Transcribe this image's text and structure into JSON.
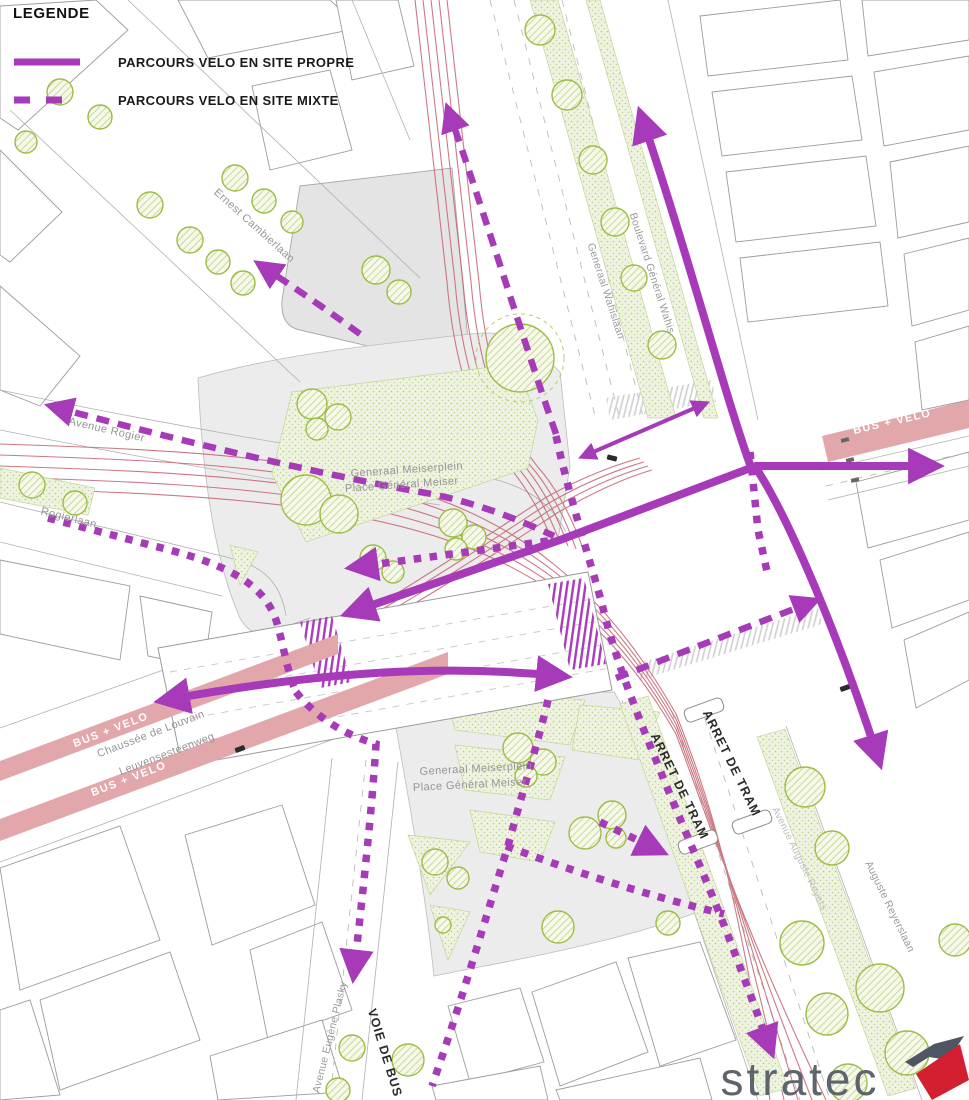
{
  "legend": {
    "title": "LEGENDE",
    "items": [
      {
        "id": "site-propre",
        "label": "PARCOURS VELO EN SITE PROPRE",
        "line_style": "solid",
        "color": "#a63ab8"
      },
      {
        "id": "site-mixte",
        "label": "PARCOURS VELO EN SITE MIXTE",
        "line_style": "dashed",
        "color": "#a63ab8"
      }
    ]
  },
  "streets": {
    "ernest_cambierlaan": "Ernest Cambierlaan",
    "boulevard_general_wahis": "Boulevard Général Wahis",
    "generaal_wahislaan": "Generaal Wahislaan",
    "avenue_rogier": "Avenue Rogier",
    "rogierlaan": "Rogierlaan",
    "chaussee_de_louvain": "Chaussée de Louvain",
    "leuvensesteenweg": "Leuvensesteenweg",
    "avenue_eugene_plasky": "Avenue Eugène Plasky",
    "auguste_reyerslaan": "Auguste Reyerslaan",
    "avenue_auguste_reyers": "Avenue Auguste Reyers"
  },
  "place": {
    "nl": "Generaal Meiserplein",
    "fr": "Place Général Meiser"
  },
  "zones": {
    "bus_velo": "BUS + VELO",
    "arret_de_tram": "ARRET DE TRAM",
    "voie_de_bus": "VOIE DE BUS"
  },
  "logo": {
    "text": "stratec"
  },
  "colors": {
    "route_purple": "#a63ab8",
    "bus_band_pink": "#e2a7ab",
    "tram_red": "#c4626e",
    "tree_green": "#9cbd44",
    "lawn_green": "#eef3e1",
    "building_gray": "#ececec",
    "logo_dark": "#4e5663",
    "logo_red": "#d41f30"
  }
}
